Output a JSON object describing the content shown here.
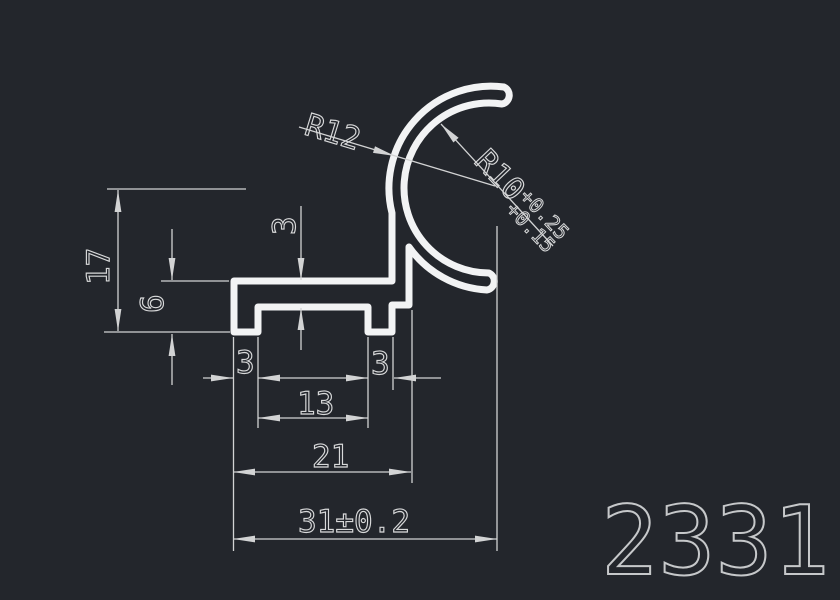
{
  "drawing": {
    "part_number": "2331",
    "radius_labels": {
      "outer": "R12",
      "inner": "R10",
      "inner_tol_upper": "+0.25",
      "inner_tol_lower": "+0.15"
    },
    "linear_labels": {
      "overall_height": "17",
      "base_height": "6",
      "wall_thickness": "3",
      "left_foot_width": "3",
      "right_foot_width": "3",
      "feet_inner_span": "13",
      "body_width": "21",
      "overall_width": "31±0.2"
    },
    "colors": {
      "background": "#23262c",
      "profile_line": "#f2f3f4",
      "dimension_line": "#d2d3d4",
      "part_number_text": "#c6c8ca"
    }
  }
}
